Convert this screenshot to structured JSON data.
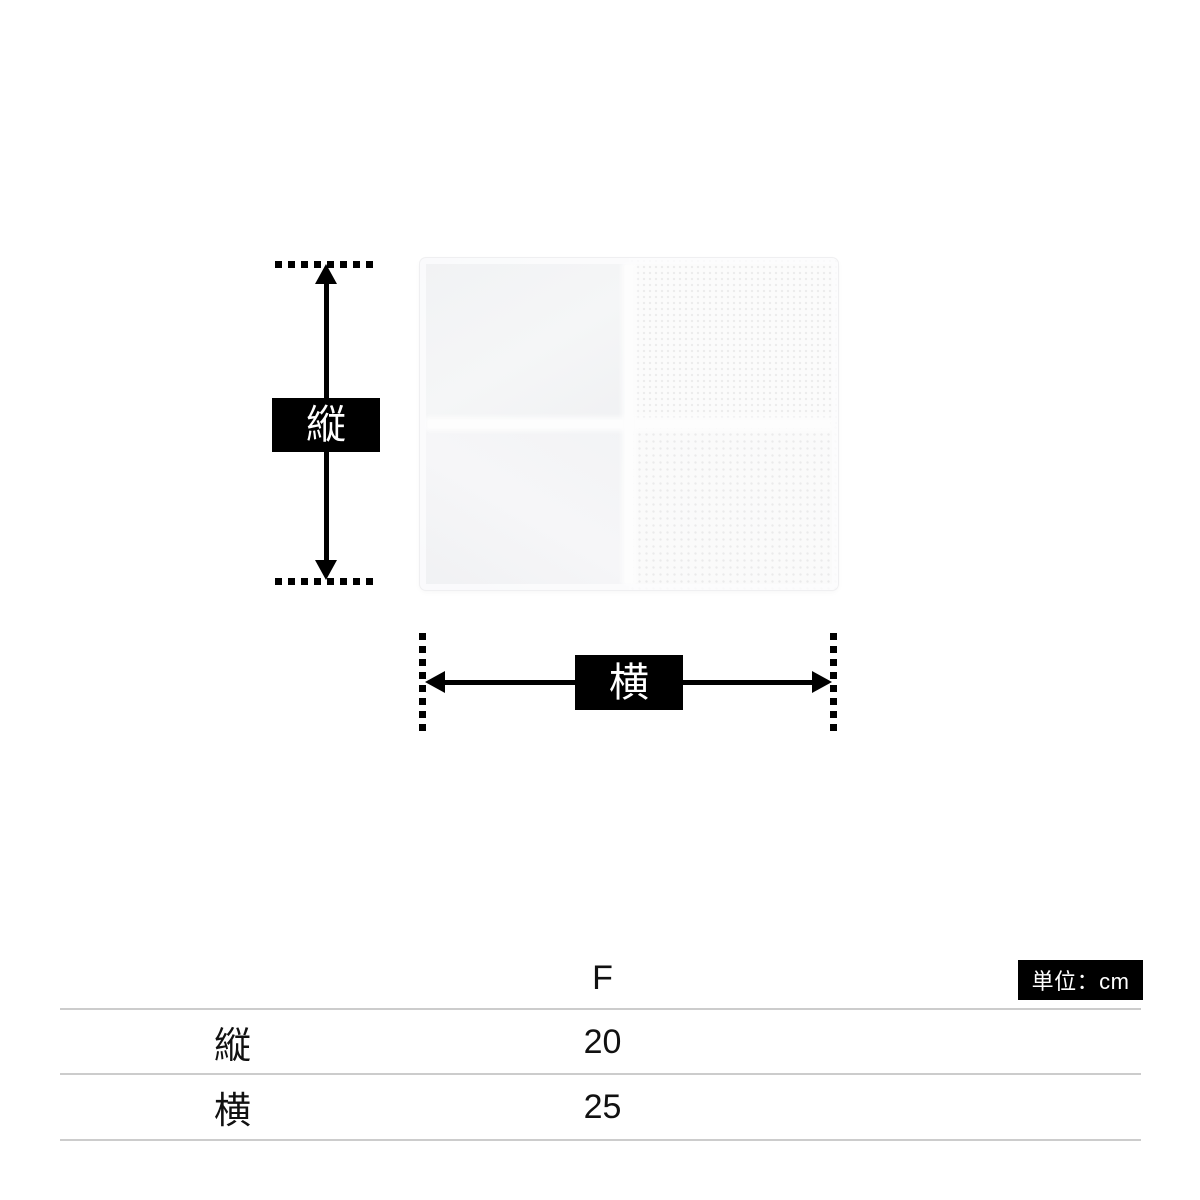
{
  "diagram": {
    "product_image": "white-terry-hand-towel",
    "vertical_label": "縦",
    "horizontal_label": "横"
  },
  "table": {
    "unit_label": "単位：cm",
    "size_column_header": "F",
    "rows": [
      {
        "label": "縦",
        "value": "20"
      },
      {
        "label": "横",
        "value": "25"
      }
    ]
  },
  "colors": {
    "background": "#ffffff",
    "arrow": "#000000",
    "label_box_bg": "#000000",
    "label_box_text": "#ffffff",
    "unit_badge_bg": "#000000",
    "unit_badge_text": "#ffffff",
    "table_line": "#cccccc",
    "table_text": "#111111",
    "towel_base": "#f5f6f7"
  }
}
